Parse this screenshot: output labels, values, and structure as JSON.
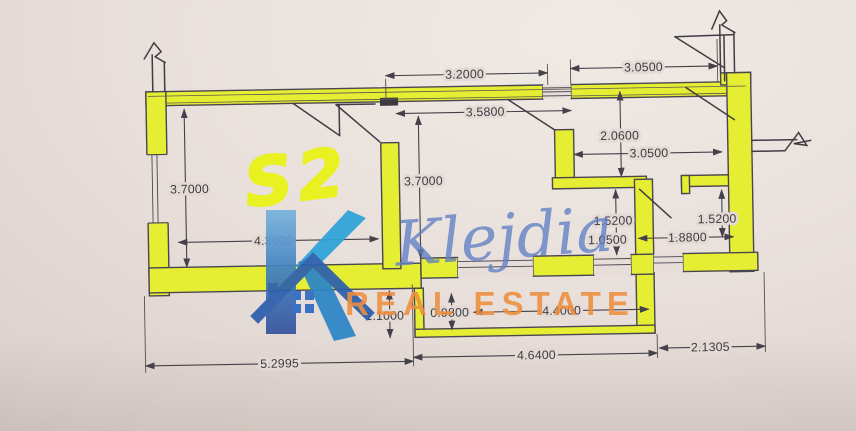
{
  "plan": {
    "room_label": "S2",
    "dimensions": {
      "top_left_width": "3.2000",
      "top_right_width": "3.0500",
      "upper_mid_width": "3.5800",
      "hall_height": "2.0600",
      "hall_width": "3.0500",
      "s2_height": "3.7000",
      "mid_height": "3.7000",
      "s2_width": "4.3000",
      "nook_height": "1.5200",
      "nook_opening": "1.0500",
      "right_room_height": "1.5200",
      "right_room_width": "1.8800",
      "balcony_side": "1.1000",
      "balcony_depth": "0.9800",
      "balcony_width": "4.4000",
      "total_left": "5.2995",
      "total_mid": "4.6400",
      "total_right": "2.1305"
    }
  },
  "watermark": {
    "initial": "K",
    "name": "Klejdia",
    "tagline": "REAL ESTATE"
  },
  "colors": {
    "wall_highlight": "#e6ee33",
    "drawing_line": "#44414a",
    "marker_yellow": "#e9f312",
    "brand_cyan": "#2ea2d8",
    "brand_blue": "#2b5fae",
    "brand_orange": "#ee8f3e",
    "script_blue": "#6080c6"
  }
}
